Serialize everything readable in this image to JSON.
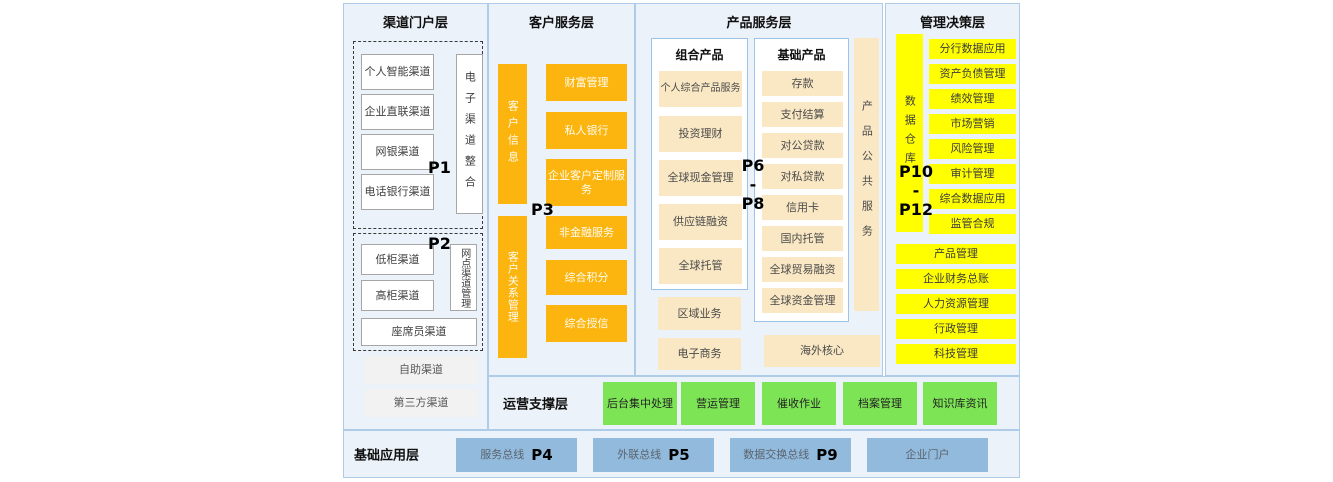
{
  "colors": {
    "panel_bg": "#ebf2f9",
    "panel_border": "#aecbe8",
    "orange": "#fcb40e",
    "cream": "#fae8c4",
    "yellow": "#ffff00",
    "green": "#7de455",
    "blue": "#92badd",
    "gray_box": "#f2f2f2",
    "white_box_border": "#a6a6a6"
  },
  "layers": {
    "channel": {
      "title": "渠道门户层",
      "p1_marker": "P1",
      "p1_boxes": [
        "个人智能渠道",
        "企业直联渠道",
        "网银渠道",
        "电话银行渠道"
      ],
      "p1_vertical": "电子渠道整合",
      "p2_marker": "P2",
      "p2_boxes": [
        "低柜渠道",
        "高柜渠道"
      ],
      "p2_vertical": "网点渠道管理",
      "p2_wide_box": "座席员渠道",
      "extra_boxes": [
        "自助渠道",
        "第三方渠道"
      ]
    },
    "customer": {
      "title": "客户服务层",
      "p3_marker": "P3",
      "vertical_bars": [
        "客户信息",
        "客户关系管理"
      ],
      "boxes": [
        "财富管理",
        "私人银行",
        "企业客户定制服务",
        "非金融服务",
        "综合积分",
        "综合授信"
      ]
    },
    "product": {
      "title": "产品服务层",
      "marker": {
        "top": "P6",
        "sep": "-",
        "bottom": "P8"
      },
      "combo": {
        "header": "组合产品",
        "boxes": [
          "个人综合产品服务",
          "投资理财",
          "全球现金管理",
          "供应链融资",
          "全球托管"
        ]
      },
      "basic": {
        "header": "基础产品",
        "boxes": [
          "存款",
          "支付结算",
          "对公贷款",
          "对私贷款",
          "信用卡",
          "国内托管",
          "全球贸易融资",
          "全球资金管理"
        ]
      },
      "vertical_bar": "产品公共服务",
      "extra_boxes": [
        "区域业务",
        "电子商务"
      ],
      "overseas_box": "海外核心"
    },
    "management": {
      "title": "管理决策层",
      "marker": {
        "top": "P10",
        "sep": "-",
        "bottom": "P12"
      },
      "vertical_bar": "数据仓库",
      "narrow_boxes": [
        "分行数据应用",
        "资产负债管理",
        "绩效管理",
        "市场营销",
        "风险管理",
        "审计管理",
        "综合数据应用",
        "监管合规"
      ],
      "wide_boxes": [
        "产品管理",
        "企业财务总账",
        "人力资源管理",
        "行政管理",
        "科技管理"
      ]
    },
    "operations": {
      "title": "运营支撑层",
      "boxes": [
        "后台集中处理",
        "营运管理",
        "催收作业",
        "档案管理",
        "知识库资讯"
      ]
    },
    "base": {
      "title": "基础应用层",
      "boxes": [
        {
          "label": "服务总线",
          "marker": "P4"
        },
        {
          "label": "外联总线",
          "marker": "P5"
        },
        {
          "label": "数据交换总线",
          "marker": "P9"
        },
        {
          "label": "企业门户",
          "marker": ""
        }
      ]
    }
  }
}
